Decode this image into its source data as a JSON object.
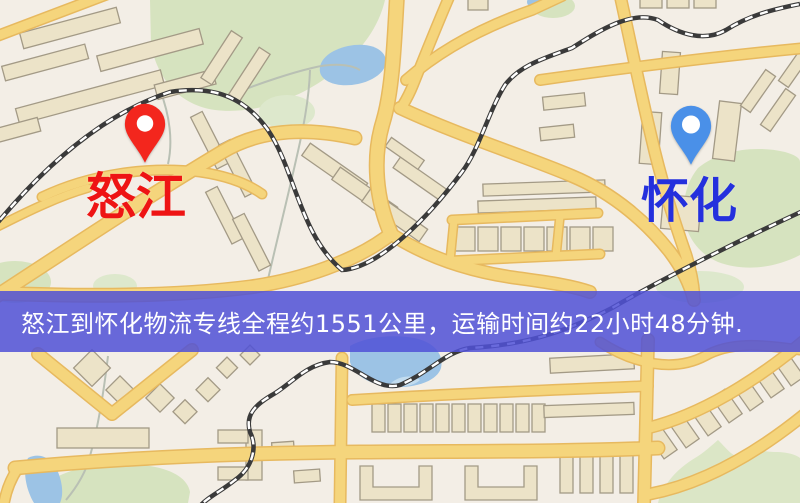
{
  "map": {
    "origin": {
      "name": "怒江",
      "pin_color": "#f3261d",
      "label_color": "#ee1414"
    },
    "destination": {
      "name": "怀化",
      "pin_color": "#4a90e8",
      "label_color": "#2430dd"
    },
    "style_colors": {
      "background": "#f3eee6",
      "road_fill": "#f5d57c",
      "road_casing": "#e7b95f",
      "building_fill": "#ece3c8",
      "park_green": "#d6e3bf",
      "water_blue": "#9cc3e5",
      "railway_dark": "#3a3a3a"
    }
  },
  "banner": {
    "text": "怒江到怀化物流专线全程约1551公里，运输时间约22小时48分钟.",
    "distance_text": "约1551公里",
    "duration_text": "约22小时48分钟",
    "background_color": "#5052d6",
    "text_color": "#ffffff"
  }
}
